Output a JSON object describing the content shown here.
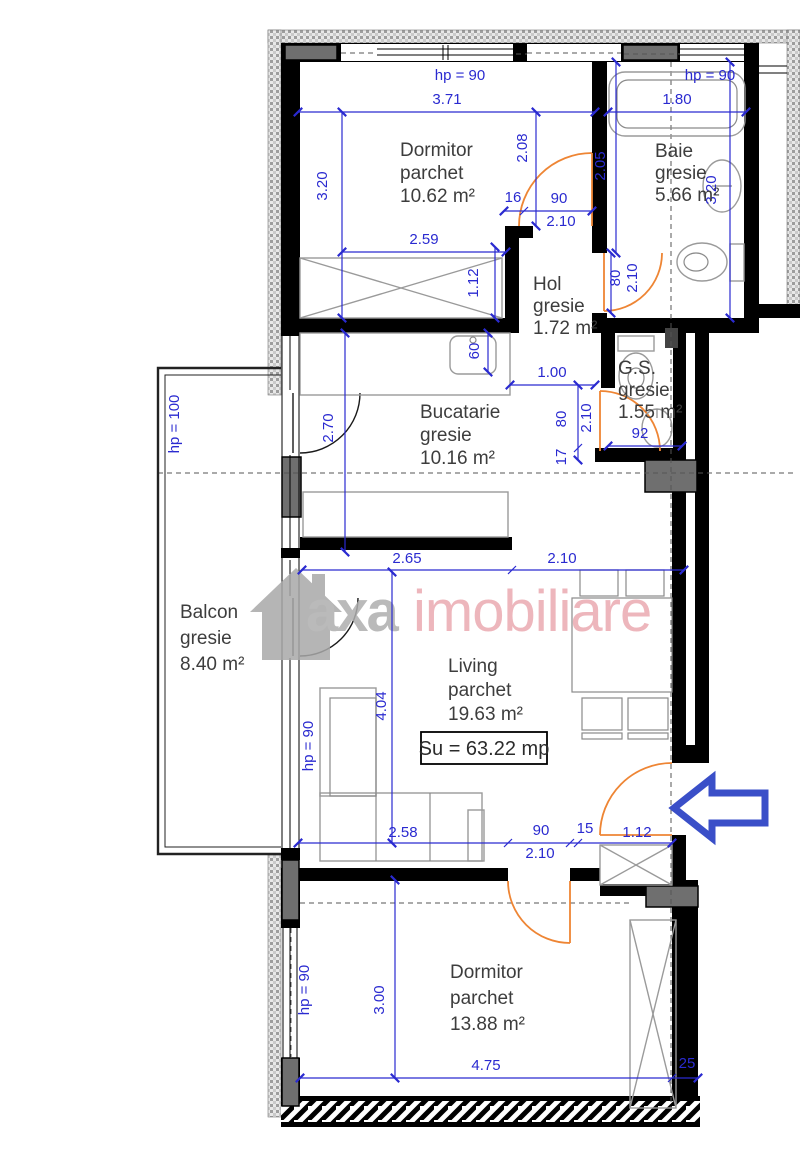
{
  "watermark": {
    "brand": "axa",
    "suffix": "imobiliare"
  },
  "summary": {
    "usable_area": "Su = 63.22 mp"
  },
  "rooms": {
    "dormitor1": {
      "name": "Dormitor",
      "floor": "parchet",
      "area": "10.62 m²"
    },
    "baie": {
      "name": "Baie",
      "floor": "gresie",
      "area": "5.66 m²"
    },
    "hol": {
      "name": "Hol",
      "floor": "gresie",
      "area": "1.72 m²"
    },
    "gs": {
      "name": "G.S.",
      "floor": "gresie",
      "area": "1.55 m²"
    },
    "bucatarie": {
      "name": "Bucatarie",
      "floor": "gresie",
      "area": "10.16 m²"
    },
    "balcon": {
      "name": "Balcon",
      "floor": "gresie",
      "area": "8.40 m²"
    },
    "living": {
      "name": "Living",
      "floor": "parchet",
      "area": "19.63 m²"
    },
    "dormitor2": {
      "name": "Dormitor",
      "floor": "parchet",
      "area": "13.88 m²"
    }
  },
  "dims": {
    "hp90_a": "hp = 90",
    "hp90_b": "hp = 90",
    "hp100": "hp = 100",
    "hp90_c": "hp = 90",
    "hp90_d": "hp = 90",
    "w371": "3.71",
    "h320l": "3.20",
    "w259": "2.59",
    "h208": "2.08",
    "n16": "16",
    "d90a": "90",
    "d210a": "2.10",
    "h112": "1.12",
    "w180": "1.80",
    "h205": "2.05",
    "h320r": "3.20",
    "d80a": "80",
    "d210b": "2.10",
    "w100": "1.00",
    "d80b": "80",
    "d210c": "2.10",
    "n17": "17",
    "n92": "92",
    "h270": "2.70",
    "n60": "60",
    "w265": "2.65",
    "w210a": "2.10",
    "h404": "4.04",
    "w258": "2.58",
    "d90b": "90",
    "d210d": "2.10",
    "n15": "15",
    "w112": "1.12",
    "h300": "3.00",
    "w475": "4.75",
    "n25": "25"
  },
  "colors": {
    "dimension": "#2a2ad0",
    "door": "#ee8534",
    "wall": "#000000",
    "furniture": "#9a9a9a",
    "watermark_gray": "#aeaeae",
    "watermark_pink": "#ebaab1",
    "arrow": "#3a4fc8",
    "column": "#6f6f6f"
  }
}
